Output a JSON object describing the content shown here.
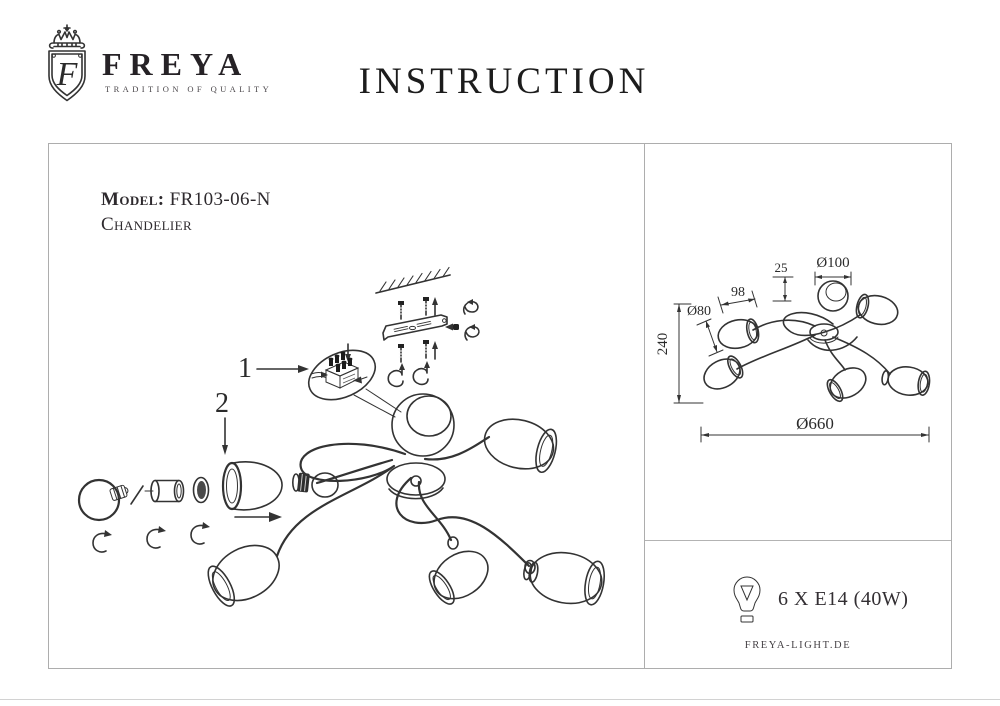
{
  "header": {
    "brand": {
      "name": "FREYA",
      "tagline": "TRADITION OF QUALITY",
      "emblem_letter": "F"
    },
    "title": "INSTRUCTION"
  },
  "left_panel": {
    "model_label": "Model:",
    "model_value": "FR103-06-N",
    "product_type": "Chandelier",
    "callout_1": "1",
    "callout_2": "2"
  },
  "right_panel": {
    "dimensions": {
      "shade_top": "Ø100",
      "canopy_drop": "25",
      "shade_width": "98",
      "shade_side": "Ø80",
      "height": "240",
      "overall_diameter": "Ø660"
    },
    "lamp_spec": "6 X E14 (40W)",
    "website": "FREYA-LIGHT.DE"
  },
  "colors": {
    "line": "#333333",
    "border": "#adadad"
  }
}
